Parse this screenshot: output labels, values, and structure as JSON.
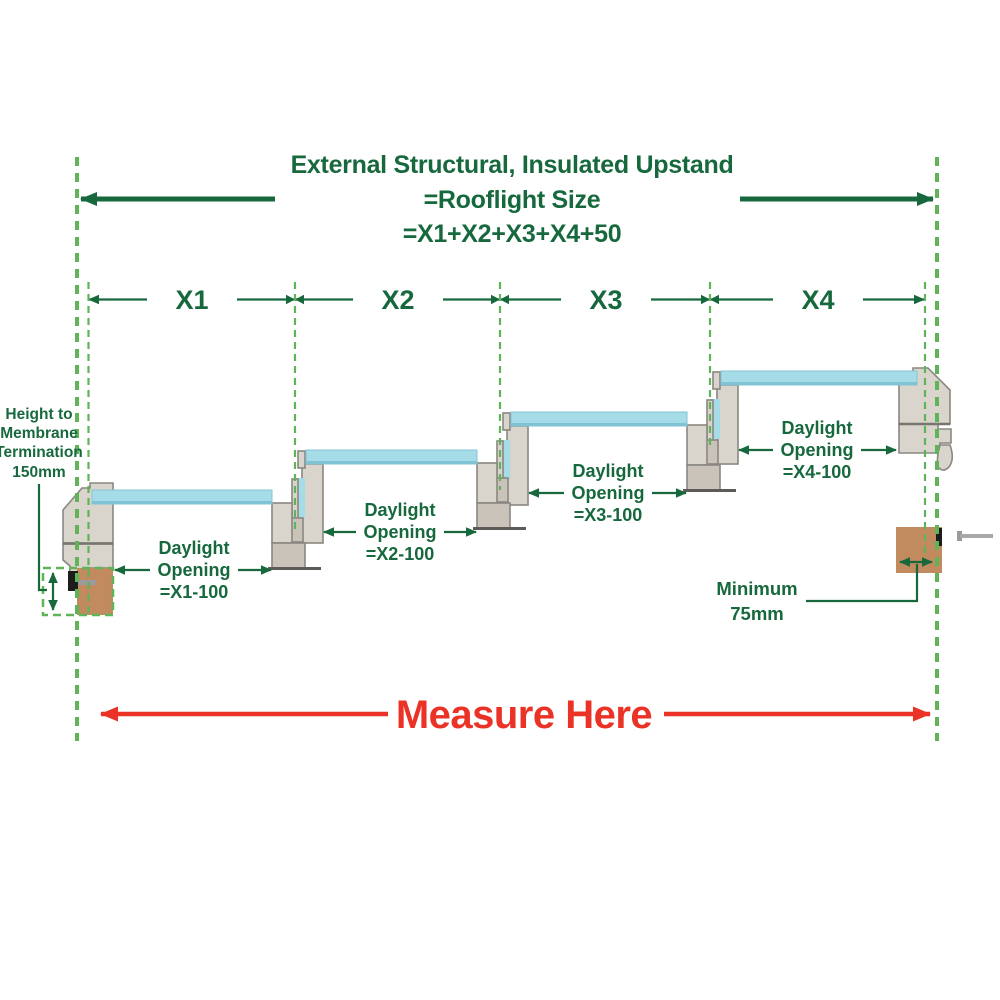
{
  "title": {
    "line1": "External Structural, Insulated Upstand",
    "line2": "=Rooflight Size",
    "line3": "=X1+X2+X3+X4+50"
  },
  "segments": {
    "x1": "X1",
    "x2": "X2",
    "x3": "X3",
    "x4": "X4"
  },
  "daylight_openings": [
    {
      "line1": "Daylight",
      "line2": "Opening",
      "line3": "=X1-100"
    },
    {
      "line1": "Daylight",
      "line2": "Opening",
      "line3": "=X2-100"
    },
    {
      "line1": "Daylight",
      "line2": "Opening",
      "line3": "=X3-100"
    },
    {
      "line1": "Daylight",
      "line2": "Opening",
      "line3": "=X4-100"
    }
  ],
  "height_annotation": {
    "line1": "Height to",
    "line2": "Membrane",
    "line3": "Termination",
    "line4": "150mm"
  },
  "minimum_annotation": {
    "line1": "Minimum",
    "line2": "75mm"
  },
  "measure_label": "Measure Here",
  "colors": {
    "dark_green": "#17693d",
    "bright_green": "#5eb457",
    "red": "#ea3326",
    "glass_blue": "#a6dbe8",
    "glass_edge": "#7fc3d4",
    "frame_light": "#d9d4cc",
    "frame_medium": "#c9c3ba",
    "wood_brown": "#c18a5f"
  }
}
